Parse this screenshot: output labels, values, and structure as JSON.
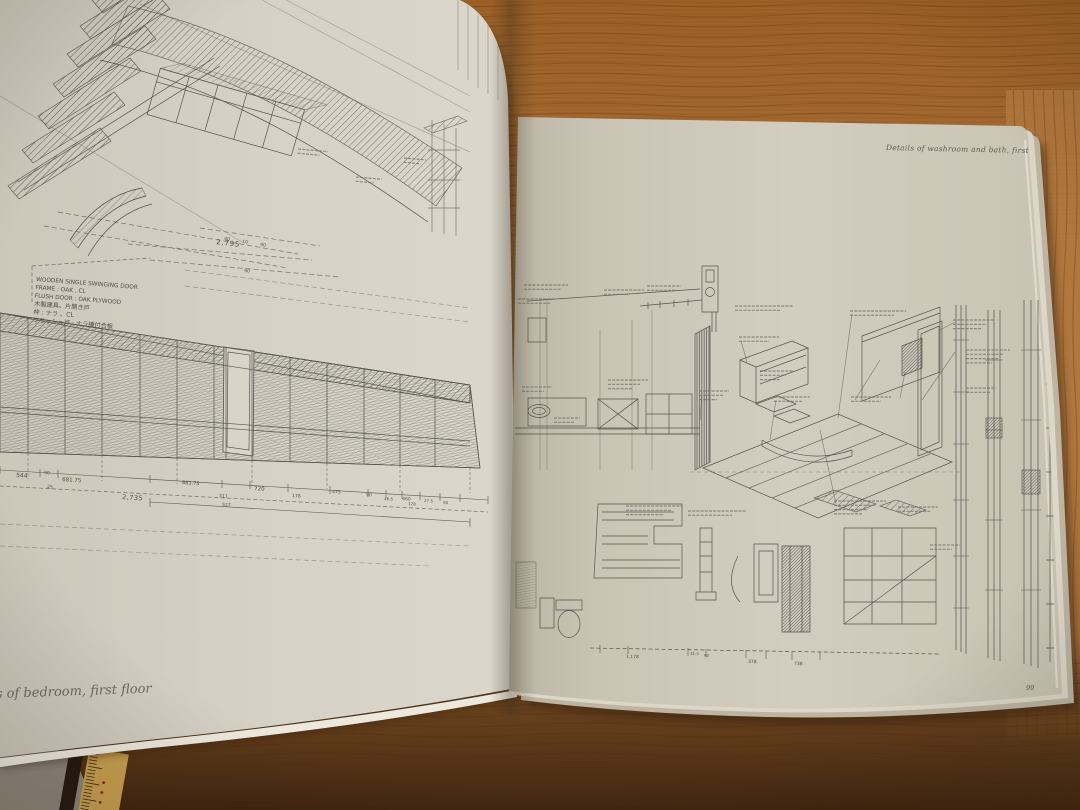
{
  "book": {
    "left_page": {
      "caption": "s of bedroom, first floor",
      "door_spec": [
        "WOODEN SINGLE SWINGING DOOR",
        "FRAME : OAK , CL",
        "FLUSH DOOR : OAK PLYWOOD",
        "木製建具、片開き戸",
        "枠 : ナラ 、CL",
        "フラッシュ戸 : ナラ練付合板"
      ],
      "dim_top_overall": "2,795",
      "dim_bottom_overall": "2,735",
      "dim_labels": [
        "544",
        "90",
        "25",
        "681.75",
        "881.75",
        "720",
        "178",
        "475",
        "90",
        "46.5",
        "460",
        "128",
        "27.5",
        "90",
        "511",
        "527"
      ],
      "axon_ticks": [
        "40",
        "10",
        "90",
        "90"
      ]
    },
    "right_page": {
      "header": "Details of washroom and bath, first floor",
      "page_number": "99",
      "dim_labels": [
        "1,178",
        "31.5",
        "90",
        "378",
        "738"
      ]
    },
    "palette": {
      "paper_left": "#d6d2c6",
      "paper_right": "#cdc7b8",
      "wood_top": "#a46b33",
      "wood_bottom": "#4f3015",
      "ink": "#56544e"
    }
  }
}
